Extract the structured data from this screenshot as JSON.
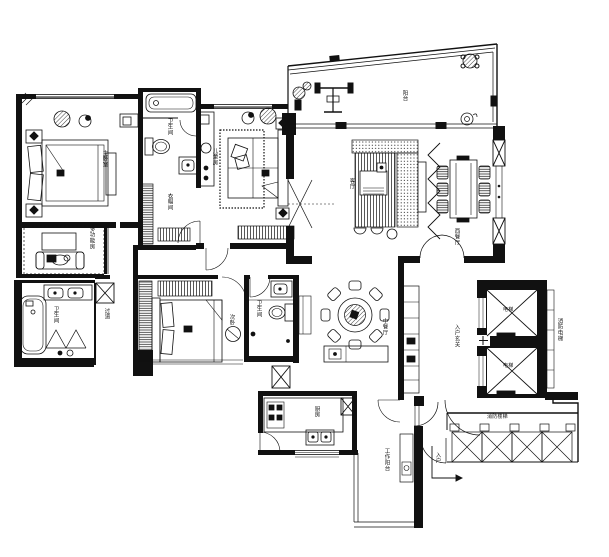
{
  "document": {
    "type": "residential apartment floor plan",
    "style": "black-and-white CAD architectural drawing",
    "background": "#ffffff",
    "ink": "#111111"
  },
  "labels": [
    {
      "name": "master-bedroom",
      "text": "主卧室"
    },
    {
      "name": "multifunction-room",
      "text": "多功能房"
    },
    {
      "name": "bathroom-top",
      "text": "卫生间"
    },
    {
      "name": "cloakroom",
      "text": "衣帽间"
    },
    {
      "name": "kids-bedroom",
      "text": "儿童房"
    },
    {
      "name": "balcony",
      "text": "阳台"
    },
    {
      "name": "living-room",
      "text": "客厅"
    },
    {
      "name": "west-dining",
      "text": "西餐厅"
    },
    {
      "name": "round-dining",
      "text": "中餐厅"
    },
    {
      "name": "foyer",
      "text": "入户玄关"
    },
    {
      "name": "elevator-1",
      "text": "电梯"
    },
    {
      "name": "elevator-2",
      "text": "电梯"
    },
    {
      "name": "fire-elevator-hall",
      "text": "消防电梯"
    },
    {
      "name": "fire-stairs",
      "text": "消防楼梯"
    },
    {
      "name": "entry",
      "text": "入户"
    },
    {
      "name": "service-balcony",
      "text": "工作阳台"
    },
    {
      "name": "kitchen",
      "text": "厨房"
    },
    {
      "name": "second-bedroom",
      "text": "次卧"
    },
    {
      "name": "bathroom-small",
      "text": "卫生间"
    },
    {
      "name": "bathroom-master",
      "text": "卫生间"
    },
    {
      "name": "hallway",
      "text": "过道"
    }
  ]
}
